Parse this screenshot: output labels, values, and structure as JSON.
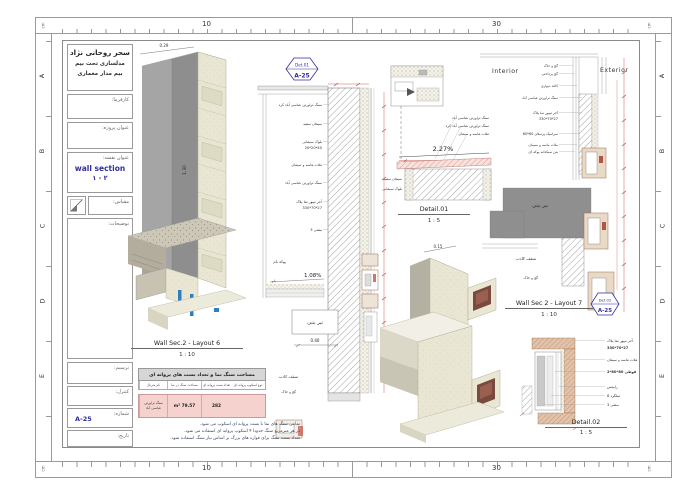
{
  "colors": {
    "accent_blue": "#2f2f9d",
    "dimension_red": "#c0392b",
    "table_pink": "#f6d2ce",
    "stone_cream": "#e9e6d3",
    "concrete_gray": "#8f8f8f",
    "brick_tan": "#e2c2a9"
  },
  "rulers": {
    "h_labels": [
      "10",
      "30"
    ],
    "unit": "cm",
    "grid_letters": [
      "A",
      "B",
      "C",
      "D",
      "E"
    ]
  },
  "title_block": {
    "author": "سحر روحانی نژاد",
    "subtitle1": "مدلسازی تحت بیم",
    "subtitle2": "بیم مدار معماری",
    "client_label": "کارفرما:",
    "project_label": "عنوان پروژه:",
    "sheet_title_label": "عنوان نقشه:",
    "sheet_title": "wall section",
    "sheet_title_no": "۲ - ۱",
    "scale_label": "مقیاس:",
    "notes_label": "توضیحات:",
    "drawn_label": "ترسیم:",
    "checked_label": "کنترل:",
    "number_label": "شماره:",
    "number_value": "A-25",
    "date_label": "تاریخ:"
  },
  "views": {
    "axon_main": {
      "title": "Wall Sec.2 - Layout 6",
      "scale": "1 : 10",
      "dim_width": "0.29",
      "dim_height": "1.30"
    },
    "mid_section": {
      "callout_ref": "Det.01",
      "callout_sheet": "A-25",
      "materials": [
        "سنگ تراورتن عباسی آباد کرد",
        "سیمان سفید",
        "بلوک سیمانی",
        "20*20*40",
        "ملات ماسه و سیمان",
        "سنگ تراورتن عباسی آباد",
        "آجر تیپور نما پلاک",
        "330*70*27",
        "نبشی 3"
      ],
      "roof_fill_label": "پوکه بام",
      "roof_label": "بام",
      "slope": "1.08%",
      "beam_label": "تیر بتنی",
      "dim": "0.40",
      "false_ceiling_label": "سقف کاذب",
      "plaster_label": "گچ و خاک"
    },
    "detail01": {
      "title": "Detail.01",
      "scale": "1 : 5",
      "slope": "2.27%",
      "labels_right": [
        "سنگ تراورتن عباسی آباد",
        "سنگ تراورتن عباسی آباد کرد",
        "ملات ماسه و سیمان"
      ],
      "labels_left": [
        "سیمان سفید",
        "بلوک سیمانی"
      ]
    },
    "axon_small": {
      "dim_a": "0.15",
      "dim_b": "0.45"
    },
    "layout7": {
      "title": "Wall Sec 2 - Layout 7",
      "scale": "1 : 10",
      "interior_label": "Interior",
      "exterior_label": "Exterior",
      "callout_ref": "Det.02",
      "callout_sheet": "A-25",
      "materials": [
        "گچ و خاک",
        "گچ پرداختی",
        "کاغذ دیواری",
        "سنگ تراورتن عباسی آباد",
        "آجر تیپور نما پلاک",
        "330*70*27",
        "سرامیک پرسلان 60*60",
        "ملات ماسه و سیمان",
        "بتن سبکدانه پوکه ای"
      ],
      "beam_label": "تیر بتنی",
      "false_ceiling_label": "سقف کاذب",
      "plaster_label": "گچ و خاک"
    },
    "detail02": {
      "title": "Detail.02",
      "scale": "1 : 5",
      "materials": [
        "آجر تیپور نما پلاک",
        "330*70*27",
        "ملات ماسه و سیمان",
        "قوطی 80*80*2",
        "رابیتس",
        "میلگرد 8",
        "نبشی 3"
      ]
    }
  },
  "table": {
    "title": "مساحت سنگ نما و تعداد بست های پروانه ای",
    "headers": [
      "نام متریال",
      "مساحت سنگ در نما",
      "تعداد بست پروانه ای",
      "نوع اسکوپ پروانه ای"
    ],
    "row": [
      "سنگ تراورتن عباسی آباد",
      "79.57 m²",
      "282",
      ""
    ],
    "notes": [
      "تمامی سنگ های نما با بست پروانه ای اسکوپ می شود.",
      "در هر مترمربع سنگ حدودا ۴ اسکوپ پروانه ای استفاده می شود.",
      "تعداد بست سنگ برای قواره های بزرگ بر اساس نیاز سنگ استفاده شود."
    ]
  }
}
